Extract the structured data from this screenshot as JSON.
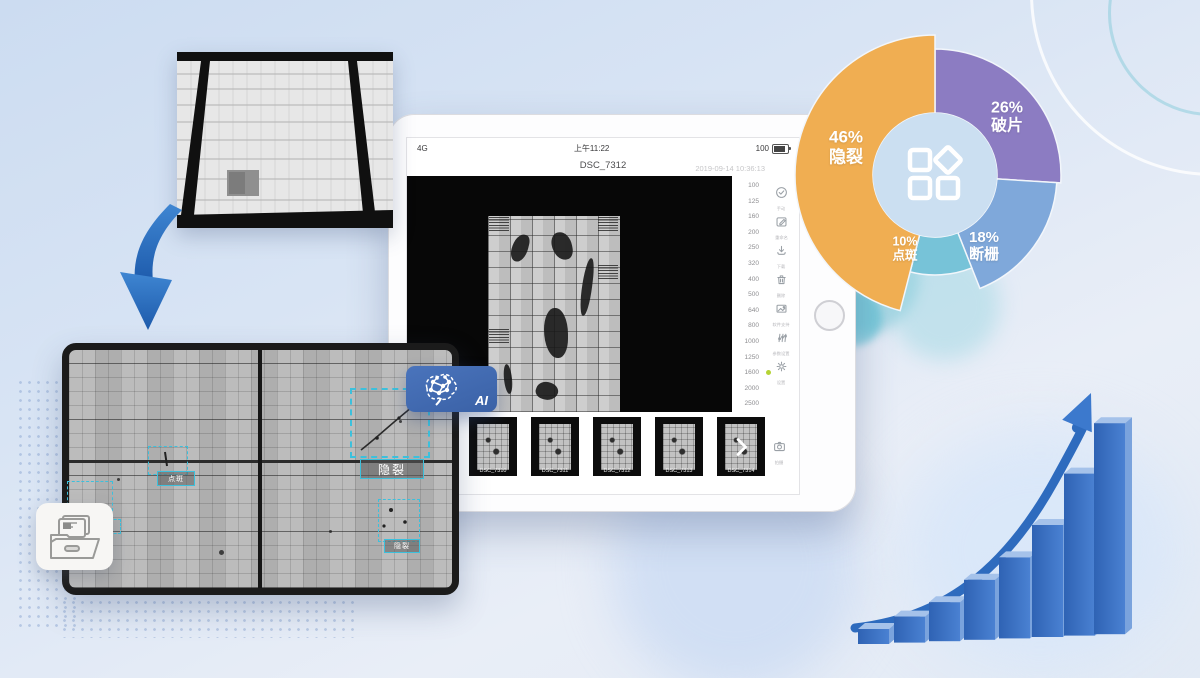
{
  "tablet": {
    "status_bar": {
      "carrier": "4G",
      "time": "上午11:22",
      "battery_percent": "100"
    },
    "title_bar": {
      "filename": "DSC_7312",
      "timestamp": "2019-09-14 10:36:13"
    },
    "iso_scale": {
      "values": [
        "100",
        "125",
        "160",
        "200",
        "250",
        "320",
        "400",
        "500",
        "640",
        "800",
        "1000",
        "1250",
        "1600",
        "2000",
        "2500"
      ],
      "selected_value": "1600",
      "indicator_color": "#b5d334"
    },
    "toolbar": {
      "items": [
        {
          "icon": "check-circle-icon",
          "label": "手动"
        },
        {
          "icon": "rename-icon",
          "label": "重命名"
        },
        {
          "icon": "download-icon",
          "label": "下载"
        },
        {
          "icon": "delete-icon",
          "label": "删除"
        },
        {
          "icon": "image-icon",
          "label": "软件支持"
        },
        {
          "icon": "adjust-icon",
          "label": "参数设置"
        },
        {
          "icon": "settings-icon",
          "label": "设置"
        }
      ]
    },
    "filmstrip": {
      "thumbnails": [
        "DSC_7310",
        "DSC_7311",
        "DSC_7312",
        "DSC_7313",
        "DSC_7314"
      ],
      "more_icon": "chevron-right-icon",
      "camera_label": "拍摄"
    }
  },
  "el_panel": {
    "accent_color": "#3cc0dc",
    "annotations": [
      {
        "text": "点斑"
      },
      {
        "text": "隐裂"
      },
      {
        "text": "隐裂"
      }
    ]
  },
  "ai_badge": {
    "label": "AI",
    "color": "#3E68B0"
  },
  "chart_data": [
    {
      "type": "pie",
      "donut": true,
      "direction": "clockwise",
      "start_angle_deg": 0,
      "legend_position": "labels-on-slices",
      "center_icon": "app-categories-icon",
      "slices": [
        {
          "label": "破片",
          "value_percent": 26,
          "color": "#8C7CC2"
        },
        {
          "label": "断栅",
          "value_percent": 18,
          "color": "#7FA8DA"
        },
        {
          "label": "点斑",
          "value_percent": 10,
          "color": "#77C3D8"
        },
        {
          "label": "隐裂",
          "value_percent": 46,
          "color": "#F0AE52"
        }
      ]
    },
    {
      "type": "bar",
      "categories": [
        "",
        "",
        "",
        "",
        "",
        "",
        "",
        ""
      ],
      "values": [
        15,
        26,
        39,
        60,
        81,
        112,
        162,
        211
      ],
      "unit": "relative-height-px",
      "bar_color": "#3a72c5",
      "trend_arrow": true,
      "trend_color": "#2e6bbe",
      "title": "",
      "xlabel": "",
      "ylabel": ""
    }
  ]
}
